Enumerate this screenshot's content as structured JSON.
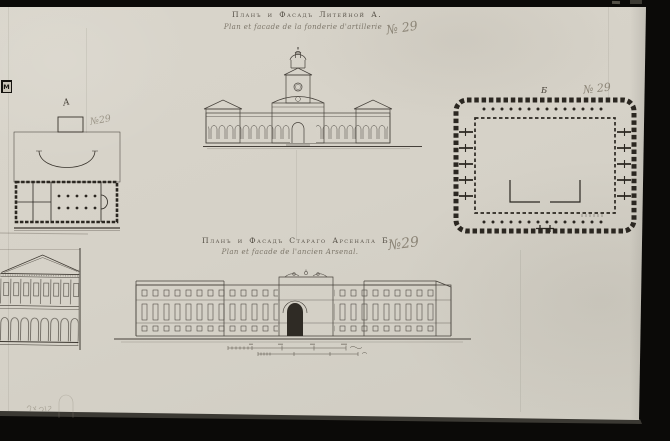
{
  "scan": {
    "background_color": "#0b0a08",
    "paper_color": "#d6d2c8",
    "ink_color": "#3c372f",
    "pencil_ink_color": "#8c8577",
    "edge_label": "М"
  },
  "foundry_sheet": {
    "title_ru": "Планъ и Фасадъ Литейной А.",
    "title_fr": "Plan et facade de la fonderie d'artillerie",
    "number_note": "№ 29",
    "plan_letter": "А",
    "plan_number_note": "№29"
  },
  "arsenal_sheet": {
    "title_ru": "Планъ и Фасадъ Стараго Арсенала Б.",
    "title_fr": "Plan et facade de l'ancien Arsenal.",
    "number_note": "№29",
    "plan_letter": "Б",
    "plan_number_note": "№ 29"
  }
}
